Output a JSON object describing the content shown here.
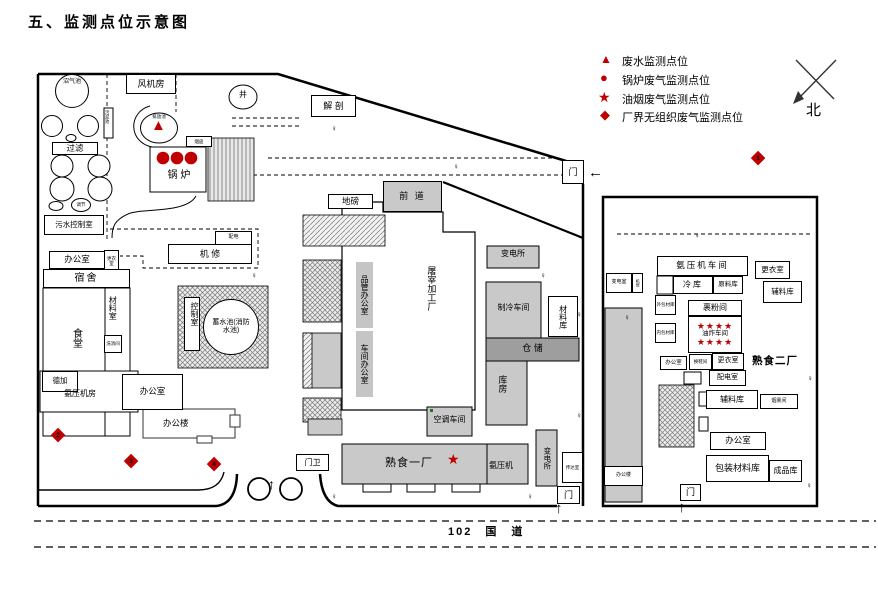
{
  "title": "五、监测点位示意图",
  "legend": {
    "i1": "废水监测点位",
    "i2": "锅炉废气监测点位",
    "i3": "油烟废气监测点位",
    "i4": "厂界无组织废气监测点位"
  },
  "north": "北",
  "road": "102　国　道",
  "marks": {
    "d1": "1",
    "d2": "2",
    "d3": "3",
    "d4": "4",
    "tri": "▲",
    "dot": "●",
    "star": "★",
    "stars4": "★★★★",
    "diamond": "◆",
    "arrow_up": "↑",
    "arrow_left": "←",
    "lamp": "♀"
  },
  "gates": {
    "gate": "门",
    "gate_guard": "门卫"
  },
  "p1": {
    "biogas_pool": "沼气池",
    "sludge_pool": "污泥池",
    "filter": "过滤",
    "regulate": "调节",
    "sewage_control_room": "污水控制室",
    "fan_room": "风机房",
    "discharge_pool": "排放池",
    "chimney": "烟囱",
    "boiler": "锅 炉",
    "office_a": "办公室",
    "changing_room": "更衣室",
    "dormitory": "宿舍",
    "canteen": "食堂",
    "material_room": "材料室",
    "wash_room": "洗消间",
    "machine_repair": "机  修",
    "power_dist": "配电",
    "control_room": "控制室",
    "water_pool": "蓄水池(消防水池)",
    "dejia": "德加",
    "ammonia_room": "氨压机房",
    "office_b": "办公室",
    "office_building": "办公楼",
    "weighbridge": "地磅",
    "front_section": "前 道",
    "dissection": "解 剖",
    "well": "井",
    "qc_office": "品管办公室",
    "workshop_office": "车间办公室",
    "slaughter_plant": "屠宰加工厂",
    "substation_a": "变电所",
    "refrigeration": "制冷车间",
    "material_wh": "材料库",
    "storage": "仓  储",
    "warehouse": "库房",
    "ac_workshop": "空调车间",
    "substation_b": "变电所",
    "duty_room": "传达室",
    "cooked_food_1": "熟食一厂",
    "ammonia_comp": "氨压机"
  },
  "p2": {
    "name": "熟食二厂",
    "transformer_room": "变电室",
    "repair": "机修",
    "ammonia_workshop": "氨压机车间",
    "cold_storage": "冷库",
    "raw_material_wh": "原料库",
    "changing_room_a": "更衣室",
    "aux_material_wh_a": "辅料库",
    "outer_pack_wh": "外包材库",
    "inner_pack_wh": "内包材库",
    "flour_room": "裹粉间",
    "frying_workshop": "油炸车间",
    "office_a": "办公室",
    "shoe_room": "换鞋间",
    "changing_room_b": "更衣室",
    "power_room": "配电室",
    "aux_material_wh_b": "辅料库",
    "smoke_room": "烟熏间",
    "office_b": "办公室",
    "packing_material_wh": "包装材料库",
    "finished_wh": "成品库",
    "office_small": "办公楼"
  }
}
